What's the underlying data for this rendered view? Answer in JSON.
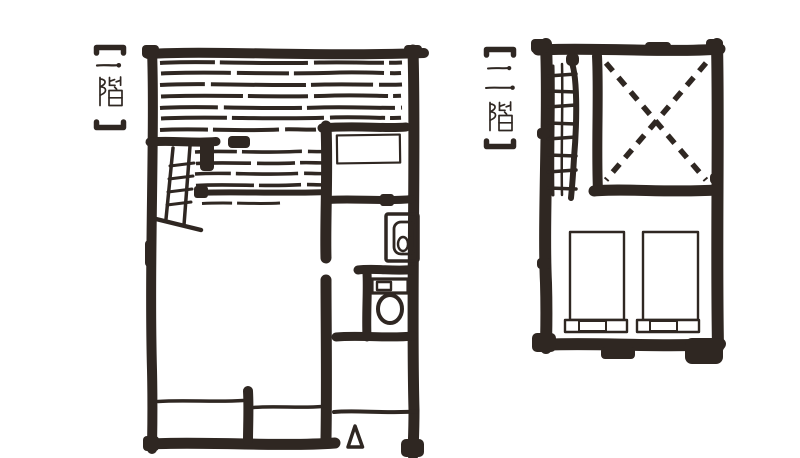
{
  "page": {
    "background_color": "#ffffff",
    "ink_color": "#2f2722"
  },
  "plans": [
    {
      "name": "一階",
      "label": "【一階】"
    },
    {
      "name": "二階",
      "label": "【二階】"
    }
  ]
}
